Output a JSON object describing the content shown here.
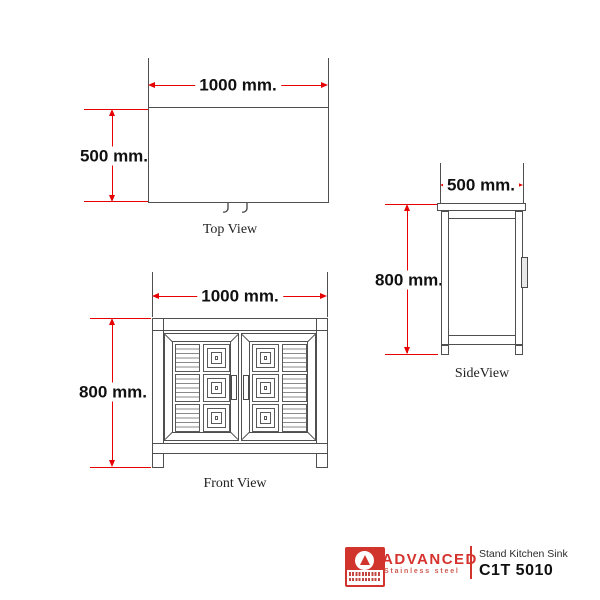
{
  "drawing": {
    "top_view": {
      "caption": "Top View",
      "width_label": "1000 mm.",
      "depth_label": "500 mm."
    },
    "front_view": {
      "caption": "Front View",
      "width_label": "1000 mm.",
      "height_label": "800 mm."
    },
    "side_view": {
      "caption": "SideView",
      "depth_label": "500 mm.",
      "height_label": "800 mm."
    }
  },
  "dimensions_mm": {
    "width": 1000,
    "depth": 500,
    "height": 800
  },
  "product": {
    "brand": "ADVANCED",
    "brand_tagline": "Stainless steel",
    "name": "Stand Kitchen Sink",
    "model": "C1T 5010"
  },
  "colors": {
    "dimension_red": "#e60000",
    "brand_red": "#d0342c",
    "line_gray": "#4f4f4f"
  }
}
